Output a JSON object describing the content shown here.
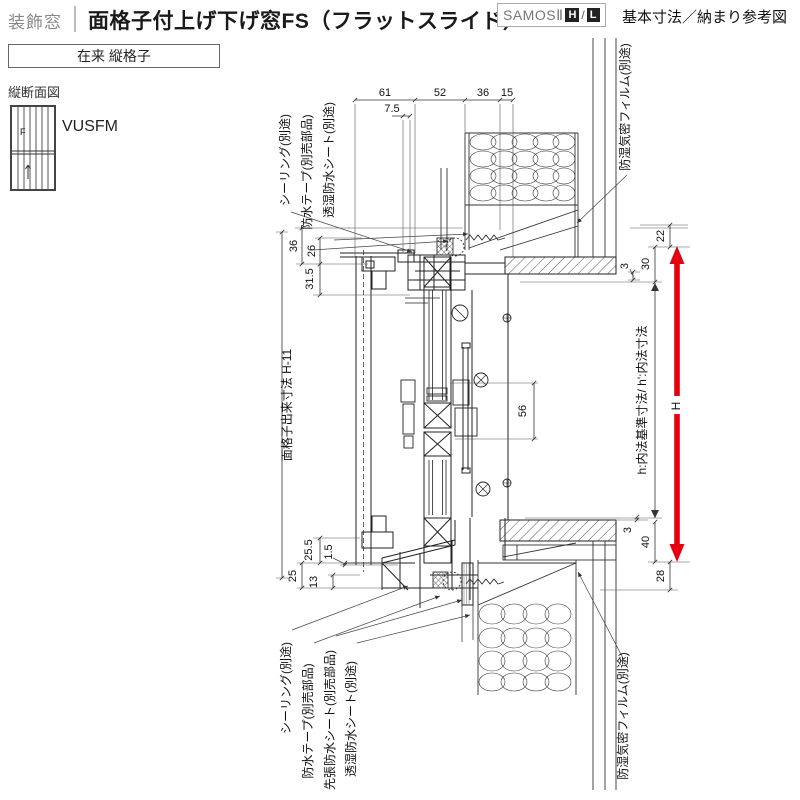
{
  "header": {
    "category": "装飾窓",
    "title": "面格子付上げ下げ窓FS（フラットスライド）",
    "series": "SAMOSⅡ",
    "grade_h": "H",
    "grade_sep": "/",
    "grade_l": "L",
    "doc_type": "基本寸法／納まり参考図"
  },
  "variant": {
    "label": "在来 縦格子"
  },
  "side": {
    "view_label": "縦断面図",
    "model_code": "VUSFM",
    "thumb_letter": "F"
  },
  "drawing": {
    "accent_color": "#e60012",
    "dims": {
      "d61": "61",
      "d52": "52",
      "d36_top": "36",
      "d15": "15",
      "d7_5": "7.5",
      "d36_left": "36",
      "d26": "26",
      "d31_5": "31.5",
      "d22": "22",
      "d30": "30",
      "d3_top": "3",
      "d56": "56",
      "d25_5": "25.5",
      "d1_5": "1.5",
      "d25": "25",
      "d13": "13",
      "d3_bottom": "3",
      "d40": "40",
      "d28": "28",
      "h_arrow": "H"
    },
    "labels": {
      "sealing_top": "シーリング(別途)",
      "tape_top": "防水テープ(別売部品)",
      "sheet_top": "透湿防水シート(別途)",
      "film_top": "防湿気密フィルム(別途)",
      "grille_dim": "面格子出来寸法 H-11",
      "inner_dim": "h:内法基準寸法/ h':内法寸法",
      "sealing_bottom": "シーリング(別途)",
      "tape_bottom": "防水テープ(別売部品)",
      "presheet_bottom": "先張防水シート(別売部品)",
      "sheet_bottom": "透湿防水シート(別途)",
      "film_bottom": "防湿気密フィルム(別途)"
    }
  }
}
